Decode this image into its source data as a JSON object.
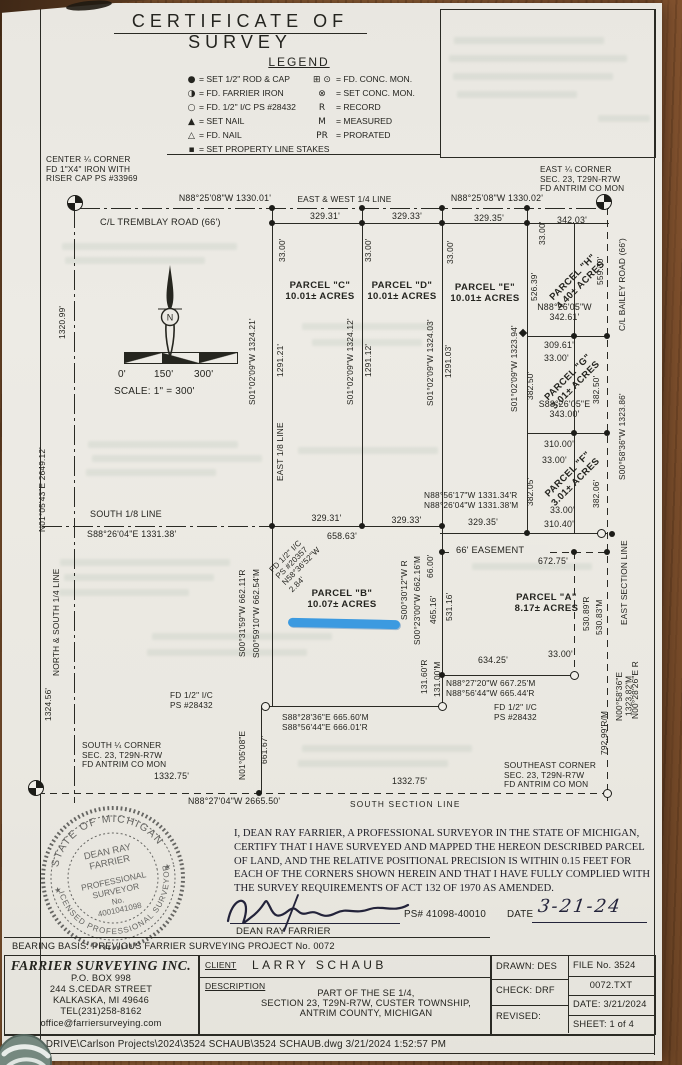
{
  "doc": {
    "title": "CERTIFICATE OF SURVEY"
  },
  "legend": {
    "title": "LEGEND",
    "left": [
      {
        "icon": "●",
        "label": "= SET 1/2\" ROD & CAP"
      },
      {
        "icon": "◑",
        "label": "= FD. FARRIER IRON"
      },
      {
        "icon": "○",
        "label": "= FD. 1/2\" I/C PS #28432"
      },
      {
        "icon": "▲",
        "label": "= SET NAIL"
      },
      {
        "icon": "△",
        "label": "= FD. NAIL"
      },
      {
        "icon": "▪",
        "label": "= SET PROPERTY LINE STAKES"
      }
    ],
    "right": [
      {
        "icon": "⊞ ⊙",
        "label": "= FD. CONC. MON."
      },
      {
        "icon": "⊗",
        "label": "= SET CONC. MON."
      },
      {
        "icon": "R",
        "label": "= RECORD"
      },
      {
        "icon": "M",
        "label": "= MEASURED"
      },
      {
        "icon": "PR",
        "label": "= PRORATED"
      }
    ]
  },
  "m": {
    "cc": "CENTER ¼ CORNER\nFD 1\"X4\" IRON WITH\nRISER CAP PS #33969",
    "ec": "EAST ¼ CORNER\nSEC. 23, T29N-R7W\nFD ANTRIM CO MON",
    "sqc": "SOUTH ¼ CORNER\nSEC. 23, T29N-R7W\nFD ANTRIM CO MON",
    "sec": "SOUTHEAST CORNER\nSEC. 23, T29N-R7W\nFD ANTRIM CO MON",
    "brg_tw": "N88°25'08\"W  1330.01'",
    "ew_line": "EAST & WEST 1/4 LINE",
    "brg_te": "N88°25'08\"W  1330.02'",
    "cl_tremblay": "C/L TREMBLAY ROAD (66')",
    "d329_31": "329.31'",
    "d329_33": "329.33'",
    "d329_35": "329.35'",
    "d342_03": "342.03'",
    "t33": "33.00'",
    "parcel_c": "PARCEL \"C\"\n10.01± ACRES",
    "parcel_d": "PARCEL \"D\"\n10.01± ACRES",
    "parcel_e": "PARCEL \"E\"\n10.01± ACRES",
    "parcel_h": "PARCEL \"H\"\n4.40± ACRES",
    "parcel_g": "PARCEL \"G\"\n3.01± ACRES",
    "parcel_f": "PARCEL \"F\"\n3.01± ACRES",
    "parcel_b": "PARCEL \"B\"\n10.07± ACRES",
    "parcel_a": "PARCEL \"A\"\n8.17± ACRES",
    "vc_brg": "S01°02'09\"W  1324.21'",
    "vc_seg": "1291.21'",
    "vd_brg": "S01°02'09\"W  1324.12'",
    "vd_seg": "1291.12'",
    "ve_brg": "S01°02'09\"W  1324.03'",
    "ve_seg": "1291.03'",
    "vh_brg": "S01°02'09\"W  1323.94'",
    "east_eighth": "EAST 1/8 LINE",
    "v1320_99": "1320.99'",
    "n0105": "N01°05'43\"E  2649.12'",
    "ns_quarter": "NORTH & SOUTH 1/4 LINE",
    "v1324_56": "1324.56'",
    "v526_39": "526.39'",
    "v559_30": "559.30'",
    "cl_bailey": "C/L BAILEY ROAD (66')",
    "brg_h_s": "N88°26'05\"W\n342.61'",
    "d309_61": "309.61'",
    "v382_50": "382.50'",
    "bailey_brg": "S00°58'36\"W  1323.86'",
    "brg_g_s": "S88°26'05\"E\n343.00'",
    "d310_00": "310.00'",
    "v382_05": "382.05'",
    "v382_06": "382.06'",
    "d310_40": "310.40'",
    "south_eighth": "SOUTH 1/8 LINE",
    "brg_eighth": "S88°26'04\"E  1331.38'",
    "brg_eighth_r": "N88°56'17\"W  1331.34'R\nN88°26'04\"W  1331.38'M",
    "d658_63": "658.63'",
    "fd20357": "FD 1/2\" I/C\nPS #20357\nN58°36'52\"W\n2.84'",
    "easement": "66' EASEMENT",
    "d672_75": "672.75'",
    "vb_w1": "S00°31'59\"W 662.11'R",
    "vb_w2": "S00°59'10\"W 662.54'M",
    "vb_e1": "S00°30'12\"W R",
    "vb_e2": "S00°23'00\"W 662.16'M",
    "v66_00": "66.00'",
    "v465_16": "465.16'",
    "v531_16": "531.16'",
    "va_e1": "530.89'R",
    "va_e2": "530.83'M",
    "east_section": "EAST SECTION LINE",
    "d634_25": "634.25'",
    "brg_a_s": "N88°27'20\"W  667.25'M\nN88°56'44\"W  665.44'R",
    "v131r": "131.60'R",
    "v131m": "131.00'M",
    "brg_b_s": "S88°28'36\"E  665.60'M\nS88°56'44\"E  666.01'R",
    "fd28432": "FD 1/2\" I/C\nPS #28432",
    "n0105_08": "N01°05'08\"E",
    "v661_67": "661.67'",
    "v792_99": "792.99'R/M",
    "v1323_82": "N00°58'36\"E 1323.82'M",
    "v0028": "N00°28'26\"E R",
    "d1332_75": "1332.75'",
    "brg_south": "N88°27'04\"W  2665.50'",
    "south_section": "SOUTH SECTION LINE"
  },
  "scale": {
    "s0": "0'",
    "s150": "150'",
    "s300": "300'",
    "text": "SCALE:  1\" = 300'",
    "north": "N"
  },
  "cert": {
    "text": "I, DEAN RAY FARRIER, A PROFESSIONAL SURVEYOR IN THE STATE OF MICHIGAN, CERTIFY THAT I HAVE SURVEYED AND MAPPED THE HEREON DESCRIBED PARCEL OF LAND, AND THE RELATIVE POSITIONAL PRECISION IS WITHIN 0.15 FEET FOR EACH OF THE CORNERS SHOWN HEREIN AND THAT I HAVE FULLY COMPLIED WITH THE SURVEY REQUIREMENTS OF ACT 132 OF 1970 AS AMENDED.",
    "ps_num": "PS# 41098-40010",
    "date_label": "DATE",
    "date_value": "3-21-24",
    "name": "DEAN RAY FARRIER"
  },
  "seal": {
    "arc_top": "STATE OF MICHIGAN",
    "arc_bottom": "LICENSED PROFESSIONAL SURVEYOR",
    "star": "★",
    "line1": "DEAN RAY",
    "line2": "FARRIER",
    "line3": "PROFESSIONAL",
    "line4": "SURVEYOR",
    "line5": "No.",
    "line6": "4001041098"
  },
  "titleblock": {
    "bearing_basis": "BEARING BASIS:  PREVIOUS FARRIER SURVEYING PROJECT No. 0072",
    "company_name": "FARRIER SURVEYING INC.",
    "addr1": "P.O. BOX 998",
    "addr2": "244 S.CEDAR STREET",
    "addr3": "KALKASKA, MI 49646",
    "addr4": "TEL(231)258-8162",
    "addr5": "office@farriersurveying.com",
    "client_label": "CLIENT",
    "client_name": "LARRY SCHAUB",
    "desc_label": "DESCRIPTION",
    "desc_text": "PART OF THE SE 1/4,\nSECTION 23, T29N-R7W, CUSTER TOWNSHIP,\nANTRIM COUNTY, MICHIGAN",
    "drawn": "DRAWN: DES",
    "check": "CHECK: DRF",
    "revised": "REVISED:",
    "file_no": "FILE No. 3524",
    "file_txt": "0072.TXT",
    "date": "DATE: 3/21/2024",
    "sheet": "SHEET: 1 of 4"
  },
  "footer": {
    "path": "DATA DRIVE\\Carlson Projects\\2024\\3524 SCHAUB\\3524 SCHAUB.dwg   3/21/2024 1:52:57 PM"
  },
  "colors": {
    "highlight": "#2490e0",
    "paper": "#ebe9e3",
    "ink": "#2a2a24",
    "wood": "#8a5a33"
  }
}
